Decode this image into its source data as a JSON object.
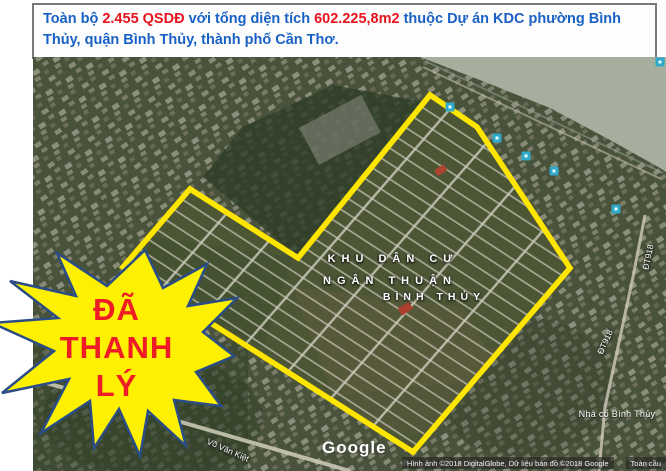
{
  "header": {
    "text_segments": [
      {
        "t": "Toàn bộ "
      },
      {
        "t": "2.455 QSDĐ"
      },
      {
        "t": " với tổng diện tích "
      },
      {
        "t": "602.225,8m2"
      },
      {
        "t": " thuộc Dự án KDC phường Bình Thủy, quận Bình Thủy, thành phố Cần Thơ."
      }
    ]
  },
  "map": {
    "labels": {
      "district_line1": "KHU DÂN CƯ",
      "district_line2": "NGÂN THUẬN",
      "ward": "BÌNH THỦY",
      "poi": "Nhà cổ Bình Thủy",
      "road_vo_van_kiet": "Võ Văn Kiệt",
      "road_dt918": "ĐT918"
    },
    "google_watermark": "Google",
    "attribution": {
      "imagery": "Hình ảnh ©2018 DigitalGlobe, Dữ liệu bản đồ ©2018 Google",
      "region": "Toàn cầu"
    }
  },
  "starburst": {
    "lines": [
      "ĐÃ",
      "THANH",
      "LÝ"
    ]
  },
  "colors": {
    "boundary_yellow": "#ffe600",
    "starburst_fill": "#fdf000",
    "starburst_stroke": "#2b4d86",
    "starburst_text": "#ee1c24",
    "header_blue": "#1961c4",
    "header_red": "#e8131d",
    "marker_teal": "#2fa9c9",
    "river_gray": "#a6ae9e"
  }
}
